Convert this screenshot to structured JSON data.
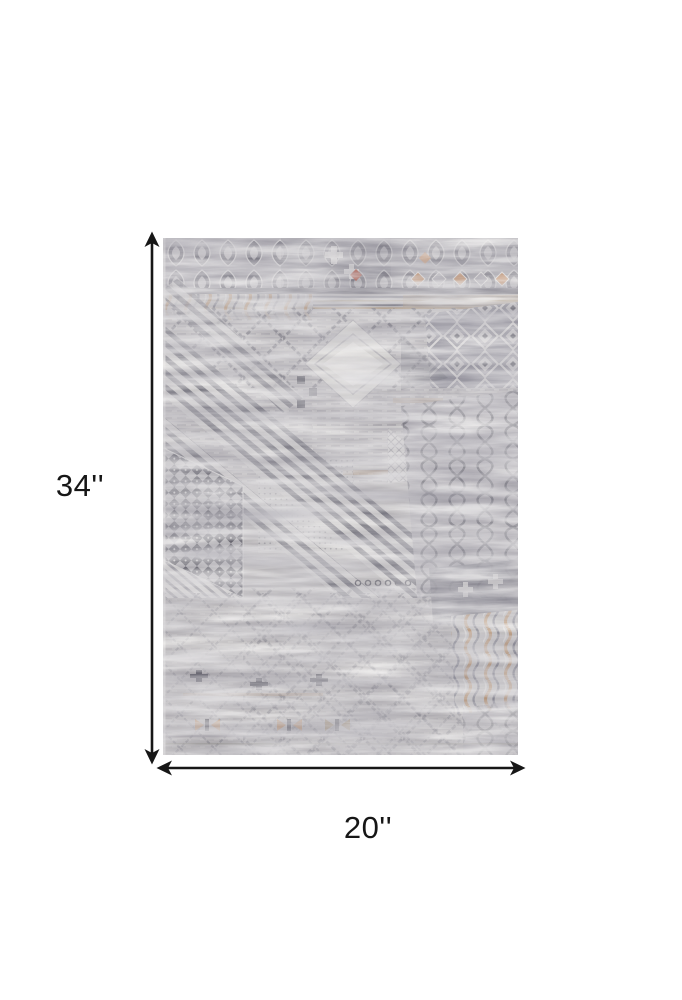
{
  "diagram": {
    "description": "distressed gray patchwork area rug shown with dimension arrows",
    "height_label": "34''",
    "width_label": "20''"
  },
  "icons": {
    "vertical_arrow": "double-headed-vertical-arrow",
    "horizontal_arrow": "double-headed-horizontal-arrow"
  },
  "colors": {
    "background": "#ffffff",
    "arrow": "#161616",
    "label_text": "#161616",
    "rug_base": "#b3b0b2",
    "rug_dark_slate": "#5e5d68",
    "rug_slate": "#83828e",
    "rug_tan": "#a87a50",
    "rug_rust": "#a0402f",
    "rug_light": "#d8d6d3"
  }
}
